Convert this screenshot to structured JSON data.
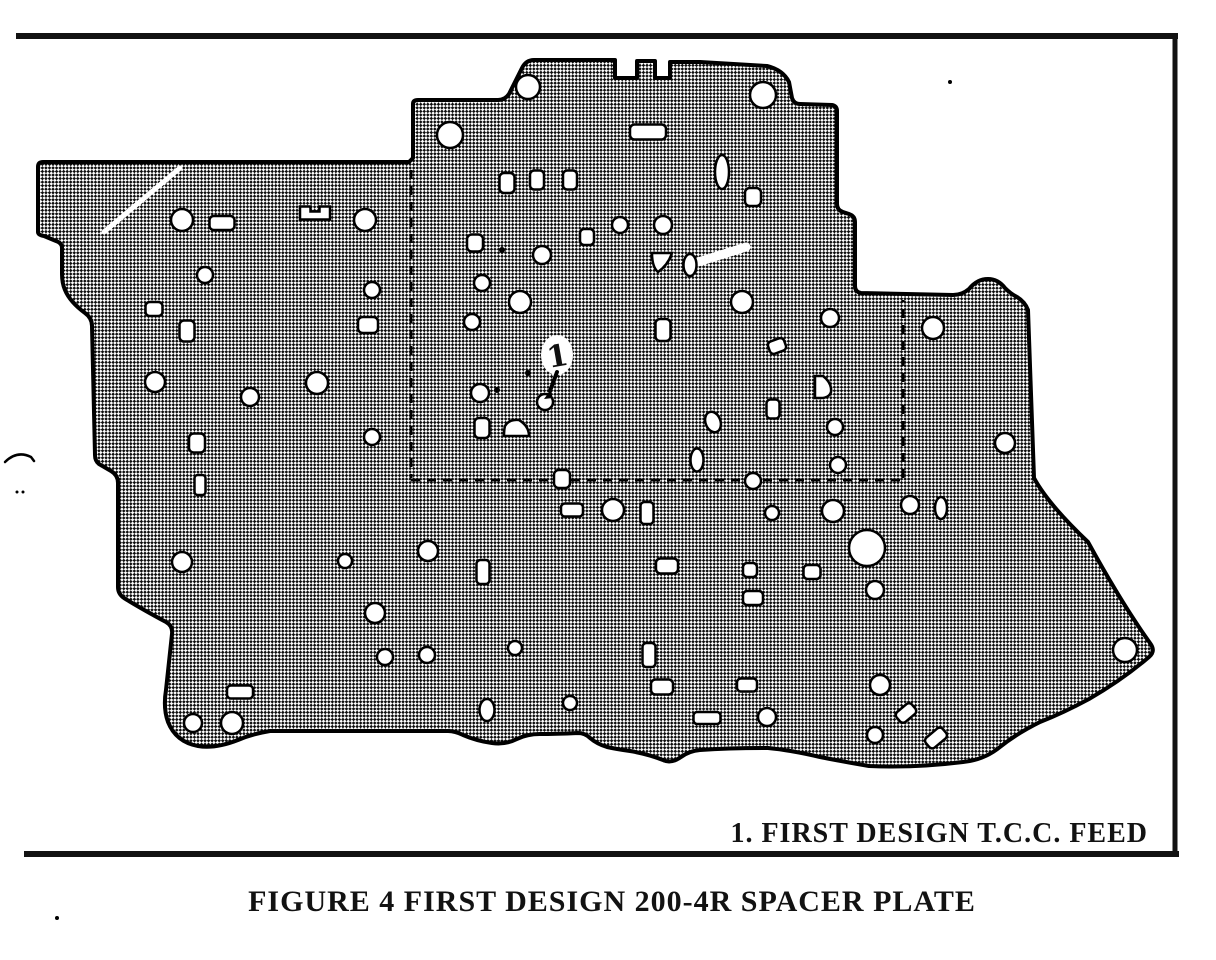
{
  "figure": {
    "annotation_label": "1.  FIRST DESIGN T.C.C. FEED",
    "caption": "FIGURE 4 FIRST DESIGN 200-4R SPACER PLATE",
    "callout_number": "1"
  },
  "colors": {
    "ink": "#121212",
    "paper": "#ffffff",
    "plate_outline": "#000000"
  },
  "frame": {
    "top": "M16,36 L1178,36",
    "right": "M1175,35 L1175,856",
    "bottom": "M24,854 L1179,854"
  },
  "plate": {
    "outline": "M38,232 L38,167 Q38,162 43,162 L409,162 L413,158 L413,104 Q413,100 418,100 L498,100 Q505,100 509,94 L522,68 Q526,60 534,60 L615,60 L615,78 L637,78 L637,61 L655,61 L655,78 L670,78 L670,62 L700,62 L767,66 Q783,70 789,82 L792,98 Q794,104 800,104 L832,105 Q837,106 837,111 L837,204 Q837,210 843,212 L849,214 Q855,216 855,222 L855,286 Q855,292 861,293 L953,295 Q962,295 969,289 Q977,279 988,279 Q998,279 1005,288 Q1011,294 1017,297 Q1025,302 1028,310 L1034,478 Q1048,504 1088,542 Q1122,604 1150,643 Q1156,651 1149,657 Q1122,680 1089,699 Q1063,713 1040,722 Q1016,734 1000,747 Q984,760 963,762 Q915,768 869,766 Q845,762 820,757 Q790,750 768,748 Q730,748 700,750 Q689,751 681,757 Q671,764 663,760 Q648,754 630,751 Q616,749 607,747 Q597,744 590,738 Q585,733 578,733 Q555,734 540,734 Q527,734 517,739 Q505,745 492,743 Q477,741 463,735 Q455,731 448,731 L270,731 Q252,734 238,740 Q215,749 198,746 Q176,742 168,722 Q163,708 166,690 L172,634 Q173,626 166,622 Q140,608 124,598 Q118,594 118,587 L118,483 Q118,475 111,471 L99,464 Q95,461 95,455 L92,326 Q92,318 85,313 Q70,302 65,290 Q62,283 62,274 L62,248 Q62,243 56,241 L44,236 Q38,235 38,232 Z",
    "holes": [
      {
        "t": "c",
        "x": 528,
        "y": 87,
        "r": 12
      },
      {
        "t": "c",
        "x": 763,
        "y": 95,
        "r": 13
      },
      {
        "t": "c",
        "x": 450,
        "y": 135,
        "r": 13
      },
      {
        "t": "c",
        "x": 182,
        "y": 220,
        "r": 11
      },
      {
        "t": "c",
        "x": 365,
        "y": 220,
        "r": 11
      },
      {
        "t": "c",
        "x": 620,
        "y": 225,
        "r": 8
      },
      {
        "t": "c",
        "x": 663,
        "y": 225,
        "r": 9
      },
      {
        "t": "c",
        "x": 542,
        "y": 255,
        "r": 9
      },
      {
        "t": "c",
        "x": 205,
        "y": 275,
        "r": 8
      },
      {
        "t": "c",
        "x": 482,
        "y": 283,
        "r": 8
      },
      {
        "t": "c",
        "x": 372,
        "y": 290,
        "r": 8
      },
      {
        "t": "c",
        "x": 520,
        "y": 302,
        "r": 11
      },
      {
        "t": "c",
        "x": 742,
        "y": 302,
        "r": 11
      },
      {
        "t": "c",
        "x": 830,
        "y": 318,
        "r": 9
      },
      {
        "t": "c",
        "x": 472,
        "y": 322,
        "r": 8
      },
      {
        "t": "c",
        "x": 933,
        "y": 328,
        "r": 11
      },
      {
        "t": "c",
        "x": 155,
        "y": 382,
        "r": 10
      },
      {
        "t": "c",
        "x": 317,
        "y": 383,
        "r": 11
      },
      {
        "t": "c",
        "x": 480,
        "y": 393,
        "r": 9
      },
      {
        "t": "c",
        "x": 250,
        "y": 397,
        "r": 9
      },
      {
        "t": "c",
        "x": 545,
        "y": 402,
        "r": 8
      },
      {
        "t": "c",
        "x": 835,
        "y": 427,
        "r": 8
      },
      {
        "t": "c",
        "x": 372,
        "y": 437,
        "r": 8
      },
      {
        "t": "c",
        "x": 838,
        "y": 465,
        "r": 8
      },
      {
        "t": "c",
        "x": 1005,
        "y": 443,
        "r": 10
      },
      {
        "t": "c",
        "x": 753,
        "y": 481,
        "r": 8
      },
      {
        "t": "c",
        "x": 613,
        "y": 510,
        "r": 11
      },
      {
        "t": "c",
        "x": 772,
        "y": 513,
        "r": 7
      },
      {
        "t": "c",
        "x": 833,
        "y": 511,
        "r": 11
      },
      {
        "t": "c",
        "x": 910,
        "y": 505,
        "r": 9
      },
      {
        "t": "c",
        "x": 428,
        "y": 551,
        "r": 10
      },
      {
        "t": "c",
        "x": 182,
        "y": 562,
        "r": 10
      },
      {
        "t": "c",
        "x": 345,
        "y": 561,
        "r": 7
      },
      {
        "t": "c",
        "x": 867,
        "y": 548,
        "r": 18
      },
      {
        "t": "c",
        "x": 875,
        "y": 590,
        "r": 9
      },
      {
        "t": "c",
        "x": 375,
        "y": 613,
        "r": 10
      },
      {
        "t": "c",
        "x": 515,
        "y": 648,
        "r": 7
      },
      {
        "t": "c",
        "x": 427,
        "y": 655,
        "r": 8
      },
      {
        "t": "c",
        "x": 385,
        "y": 657,
        "r": 8
      },
      {
        "t": "c",
        "x": 1125,
        "y": 650,
        "r": 12
      },
      {
        "t": "c",
        "x": 570,
        "y": 703,
        "r": 7
      },
      {
        "t": "c",
        "x": 767,
        "y": 717,
        "r": 9
      },
      {
        "t": "c",
        "x": 880,
        "y": 685,
        "r": 10
      },
      {
        "t": "c",
        "x": 875,
        "y": 735,
        "r": 8
      },
      {
        "t": "c",
        "x": 193,
        "y": 723,
        "r": 9
      },
      {
        "t": "c",
        "x": 232,
        "y": 723,
        "r": 11
      },
      {
        "t": "r",
        "x": 648,
        "y": 132,
        "w": 36,
        "h": 15
      },
      {
        "t": "r",
        "x": 222,
        "y": 223,
        "w": 25,
        "h": 14
      },
      {
        "t": "r",
        "x": 587,
        "y": 237,
        "w": 14,
        "h": 16
      },
      {
        "t": "r",
        "x": 475,
        "y": 243,
        "w": 16,
        "h": 17
      },
      {
        "t": "r",
        "x": 154,
        "y": 309,
        "w": 17,
        "h": 14
      },
      {
        "t": "r",
        "x": 368,
        "y": 325,
        "w": 20,
        "h": 16
      },
      {
        "t": "r",
        "x": 187,
        "y": 331,
        "w": 15,
        "h": 21
      },
      {
        "t": "r",
        "x": 663,
        "y": 330,
        "w": 15,
        "h": 22
      },
      {
        "t": "r",
        "x": 197,
        "y": 443,
        "w": 16,
        "h": 19
      },
      {
        "t": "r",
        "x": 200,
        "y": 485,
        "w": 11,
        "h": 20
      },
      {
        "t": "r",
        "x": 507,
        "y": 183,
        "w": 15,
        "h": 20
      },
      {
        "t": "r",
        "x": 537,
        "y": 180,
        "w": 14,
        "h": 19
      },
      {
        "t": "r",
        "x": 570,
        "y": 180,
        "w": 14,
        "h": 19
      },
      {
        "t": "r",
        "x": 753,
        "y": 197,
        "w": 16,
        "h": 18
      },
      {
        "t": "r",
        "x": 773,
        "y": 409,
        "w": 13,
        "h": 19
      },
      {
        "t": "r",
        "x": 482,
        "y": 428,
        "w": 15,
        "h": 20
      },
      {
        "t": "r",
        "x": 562,
        "y": 479,
        "w": 16,
        "h": 18
      },
      {
        "t": "r",
        "x": 572,
        "y": 510,
        "w": 22,
        "h": 13
      },
      {
        "t": "r",
        "x": 647,
        "y": 513,
        "w": 13,
        "h": 22
      },
      {
        "t": "r",
        "x": 483,
        "y": 572,
        "w": 13,
        "h": 24
      },
      {
        "t": "r",
        "x": 667,
        "y": 566,
        "w": 22,
        "h": 15
      },
      {
        "t": "r",
        "x": 750,
        "y": 570,
        "w": 14,
        "h": 14
      },
      {
        "t": "r",
        "x": 812,
        "y": 572,
        "w": 17,
        "h": 14
      },
      {
        "t": "r",
        "x": 753,
        "y": 598,
        "w": 20,
        "h": 14
      },
      {
        "t": "r",
        "x": 649,
        "y": 655,
        "w": 13,
        "h": 24
      },
      {
        "t": "r",
        "x": 662,
        "y": 687,
        "w": 22,
        "h": 15
      },
      {
        "t": "r",
        "x": 747,
        "y": 685,
        "w": 20,
        "h": 13
      },
      {
        "t": "r",
        "x": 707,
        "y": 718,
        "w": 27,
        "h": 12
      },
      {
        "t": "r",
        "x": 240,
        "y": 692,
        "w": 26,
        "h": 13
      },
      {
        "t": "o",
        "x": 722,
        "y": 172,
        "rx": 7,
        "ry": 17,
        "a": 0
      },
      {
        "t": "o",
        "x": 690,
        "y": 265,
        "rx": 6.5,
        "ry": 11,
        "a": 0
      },
      {
        "t": "o",
        "x": 713,
        "y": 422,
        "rx": 7.5,
        "ry": 10.5,
        "a": -20
      },
      {
        "t": "o",
        "x": 697,
        "y": 460,
        "rx": 6.5,
        "ry": 11.5,
        "a": 0
      },
      {
        "t": "o",
        "x": 941,
        "y": 508,
        "rx": 6,
        "ry": 11,
        "a": 0
      },
      {
        "t": "o",
        "x": 487,
        "y": 710,
        "rx": 7.5,
        "ry": 11,
        "a": 0
      },
      {
        "t": "tr",
        "x": 777,
        "y": 346,
        "w": 17,
        "h": 13,
        "a": -20
      },
      {
        "t": "tr",
        "x": 906,
        "y": 713,
        "w": 20,
        "h": 13,
        "a": -40
      },
      {
        "t": "tr",
        "x": 936,
        "y": 738,
        "w": 22,
        "h": 13,
        "a": -40
      },
      {
        "t": "nr",
        "x": 315,
        "y": 213
      },
      {
        "t": "w1",
        "x": 662,
        "y": 263
      },
      {
        "t": "w2",
        "x": 517,
        "y": 428
      },
      {
        "t": "d",
        "x": 823,
        "y": 387
      }
    ],
    "dashed_lines": [
      "M411,170 L411,478",
      "M411,480 L903,480",
      "M903,478 L903,300"
    ],
    "scratches": [
      {
        "d": "M104,232 L180,168",
        "w": 5
      },
      {
        "d": "M698,262 L746,247",
        "w": 9
      }
    ],
    "specks": [
      [
        950,
        82,
        2
      ],
      [
        502,
        250,
        3
      ],
      [
        528,
        373,
        3
      ],
      [
        497,
        390,
        3
      ],
      [
        57,
        918,
        2
      ],
      [
        17,
        492,
        1.5
      ],
      [
        23,
        492,
        1.5
      ]
    ],
    "margin_mark": "M5,462 Q17,450 31,457 L34,461",
    "annotation_arrow": {
      "patch": {
        "x": 557,
        "y": 355,
        "rx": 16,
        "ry": 20
      },
      "digit": {
        "x": 549,
        "y": 368,
        "rot": -10
      },
      "stem": "M557,372 Q553,383 550,391",
      "tip": "M550,391 L544,399 L553,398 Z"
    }
  }
}
